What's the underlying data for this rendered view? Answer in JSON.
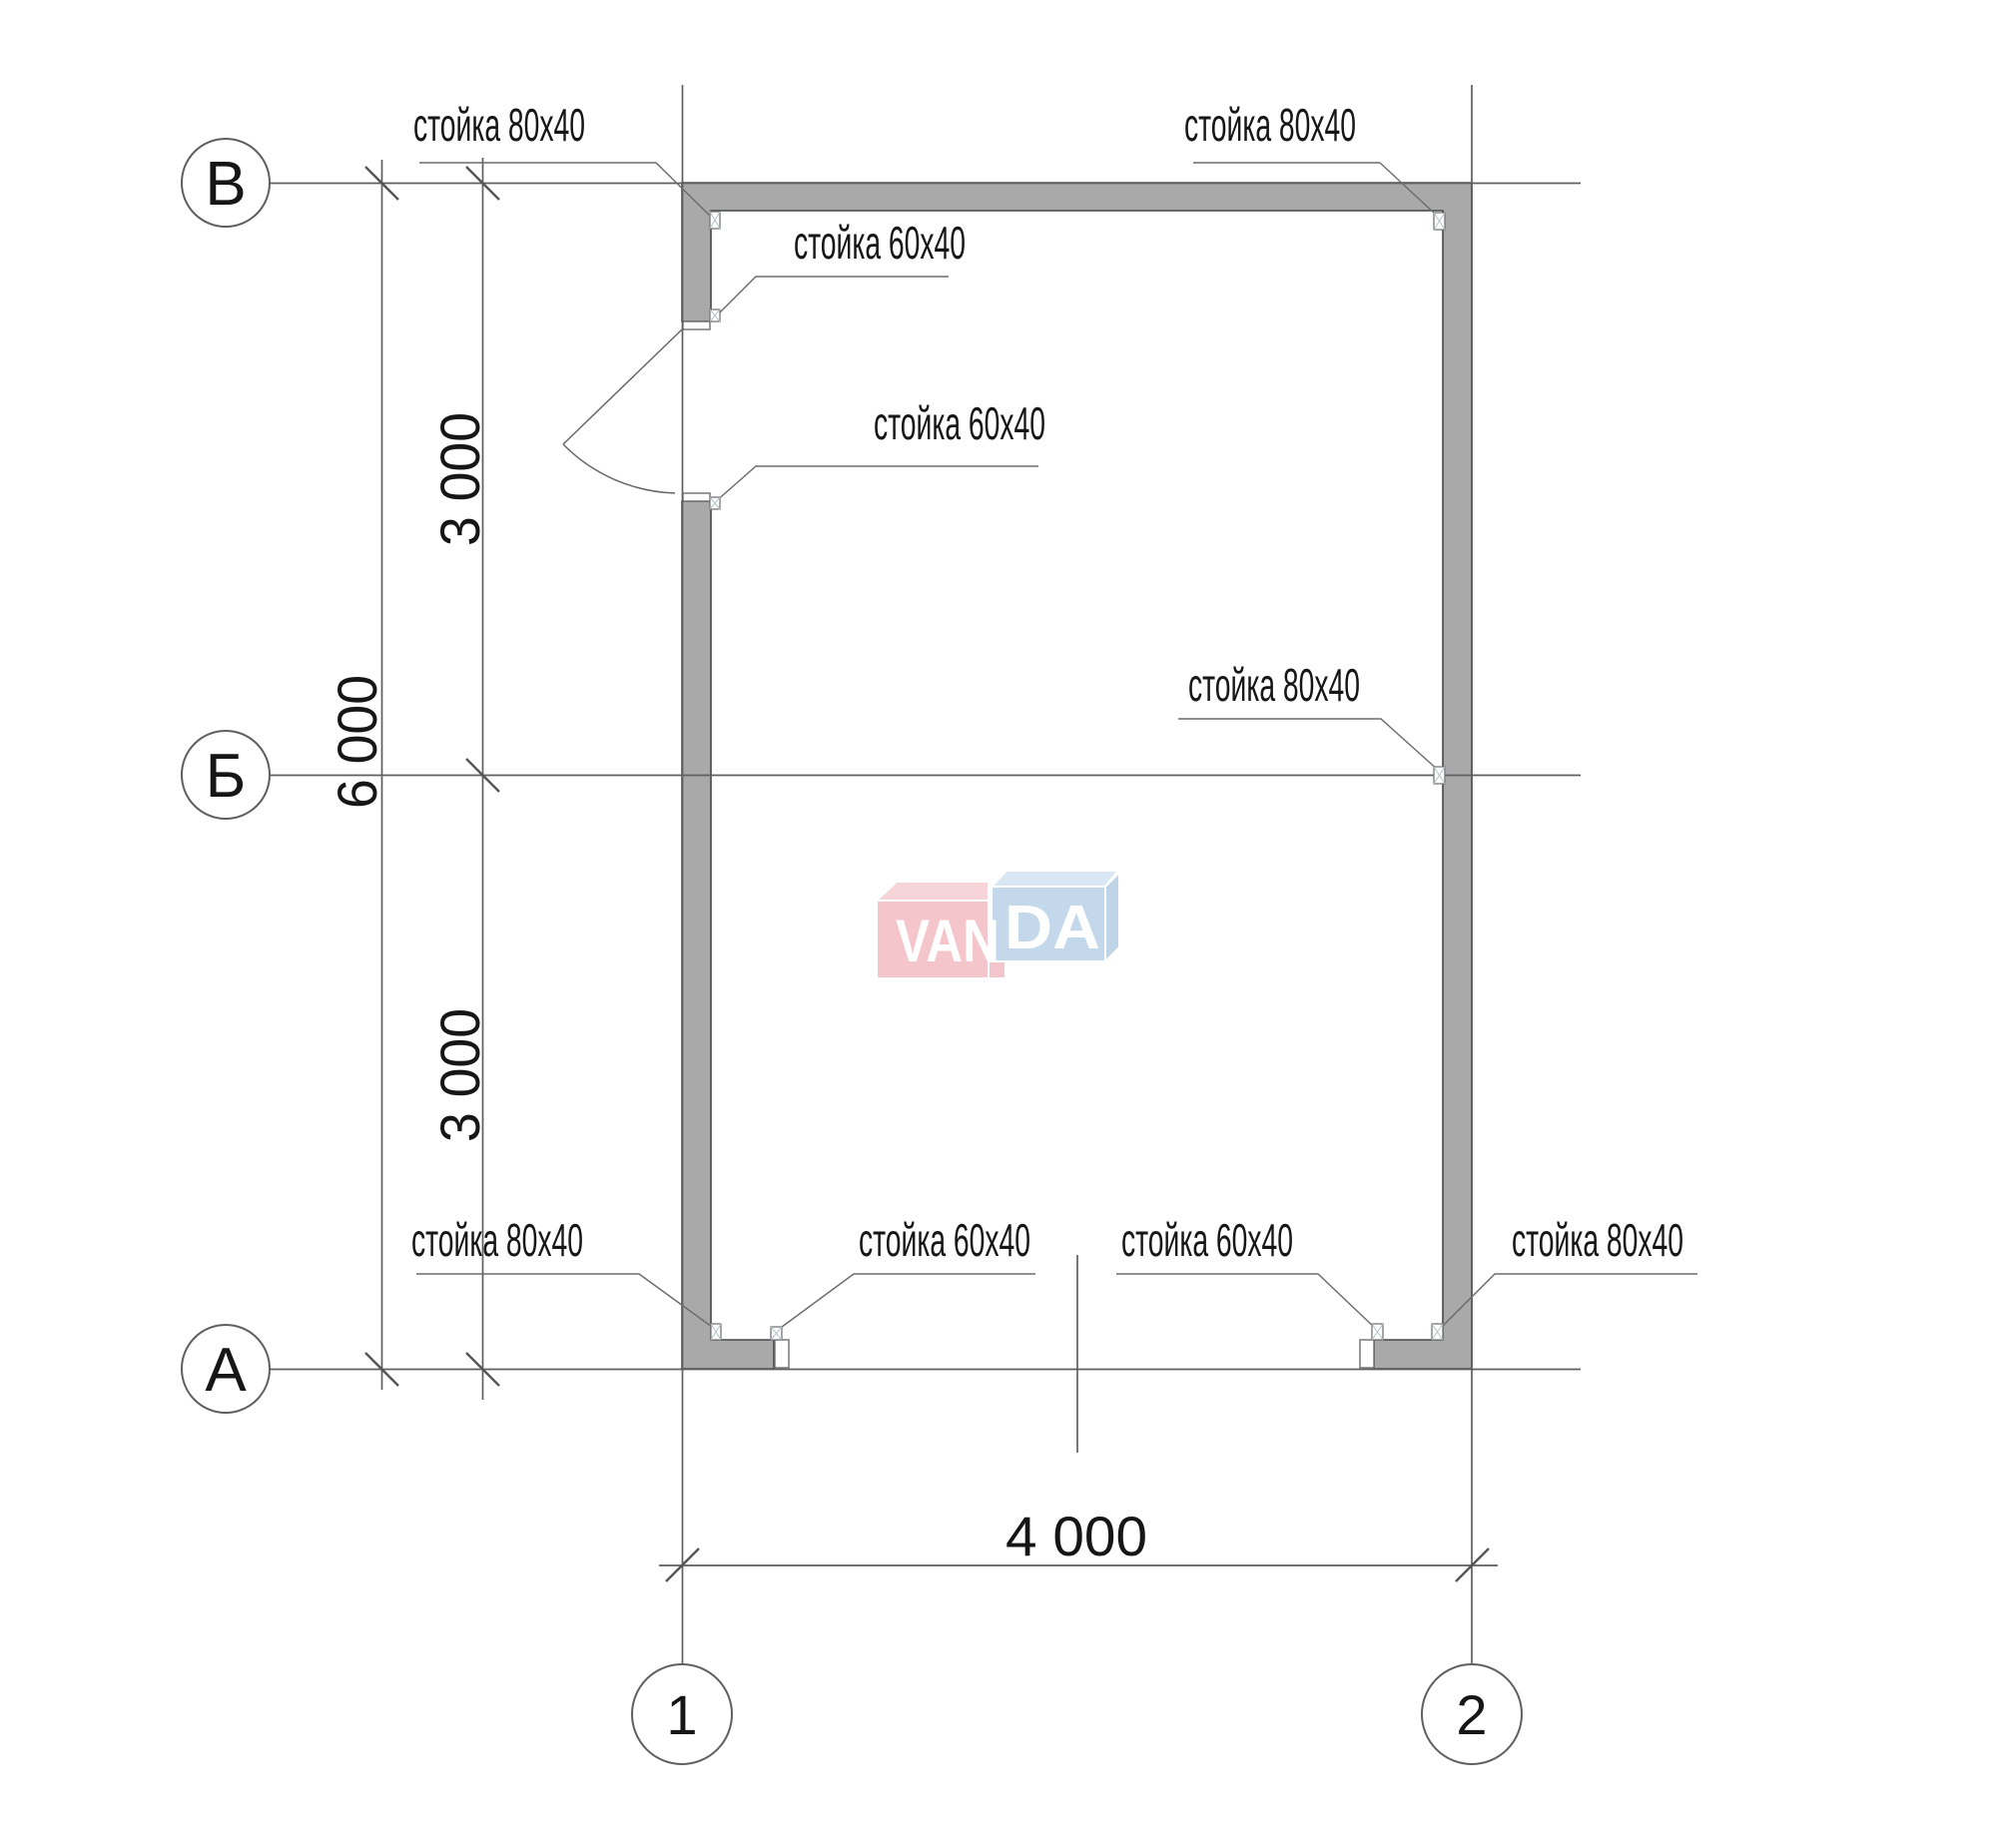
{
  "drawing_type": "floor-plan",
  "axes": {
    "rows": [
      {
        "label": "В"
      },
      {
        "label": "Б"
      },
      {
        "label": "А"
      }
    ],
    "cols": [
      {
        "label": "1"
      },
      {
        "label": "2"
      }
    ]
  },
  "dimensions": {
    "left_total": "6 000",
    "left_upper": "3 000",
    "left_lower": "3 000",
    "bottom_width": "4 000"
  },
  "callouts": [
    {
      "text": "стойка 80x40"
    },
    {
      "text": "стойка 80x40"
    },
    {
      "text": "стойка 60x40"
    },
    {
      "text": "стойка 60x40"
    },
    {
      "text": "стойка 80x40"
    },
    {
      "text": "стойка 80x40"
    },
    {
      "text": "стойка 60x40"
    },
    {
      "text": "стойка 60x40"
    },
    {
      "text": "стойка 80x40"
    }
  ],
  "watermark": {
    "part1": "VAN",
    "part2": "DA",
    "full": "VANDA"
  },
  "colors": {
    "wall_fill": "#a9a9a9",
    "wall_outline": "#474747",
    "line": "#5f5f5f",
    "leader": "#6b6b6b",
    "post_cross": "#b7c6c6",
    "text": "#161616",
    "watermark_pink": "#f4c5ca",
    "watermark_pink_light": "#f7d4d8",
    "watermark_blue": "#c4d8eb",
    "watermark_blue_light": "#d9e7f5",
    "watermark_blue_side": "#c0d4e8",
    "watermark_text": "#ffffff"
  }
}
